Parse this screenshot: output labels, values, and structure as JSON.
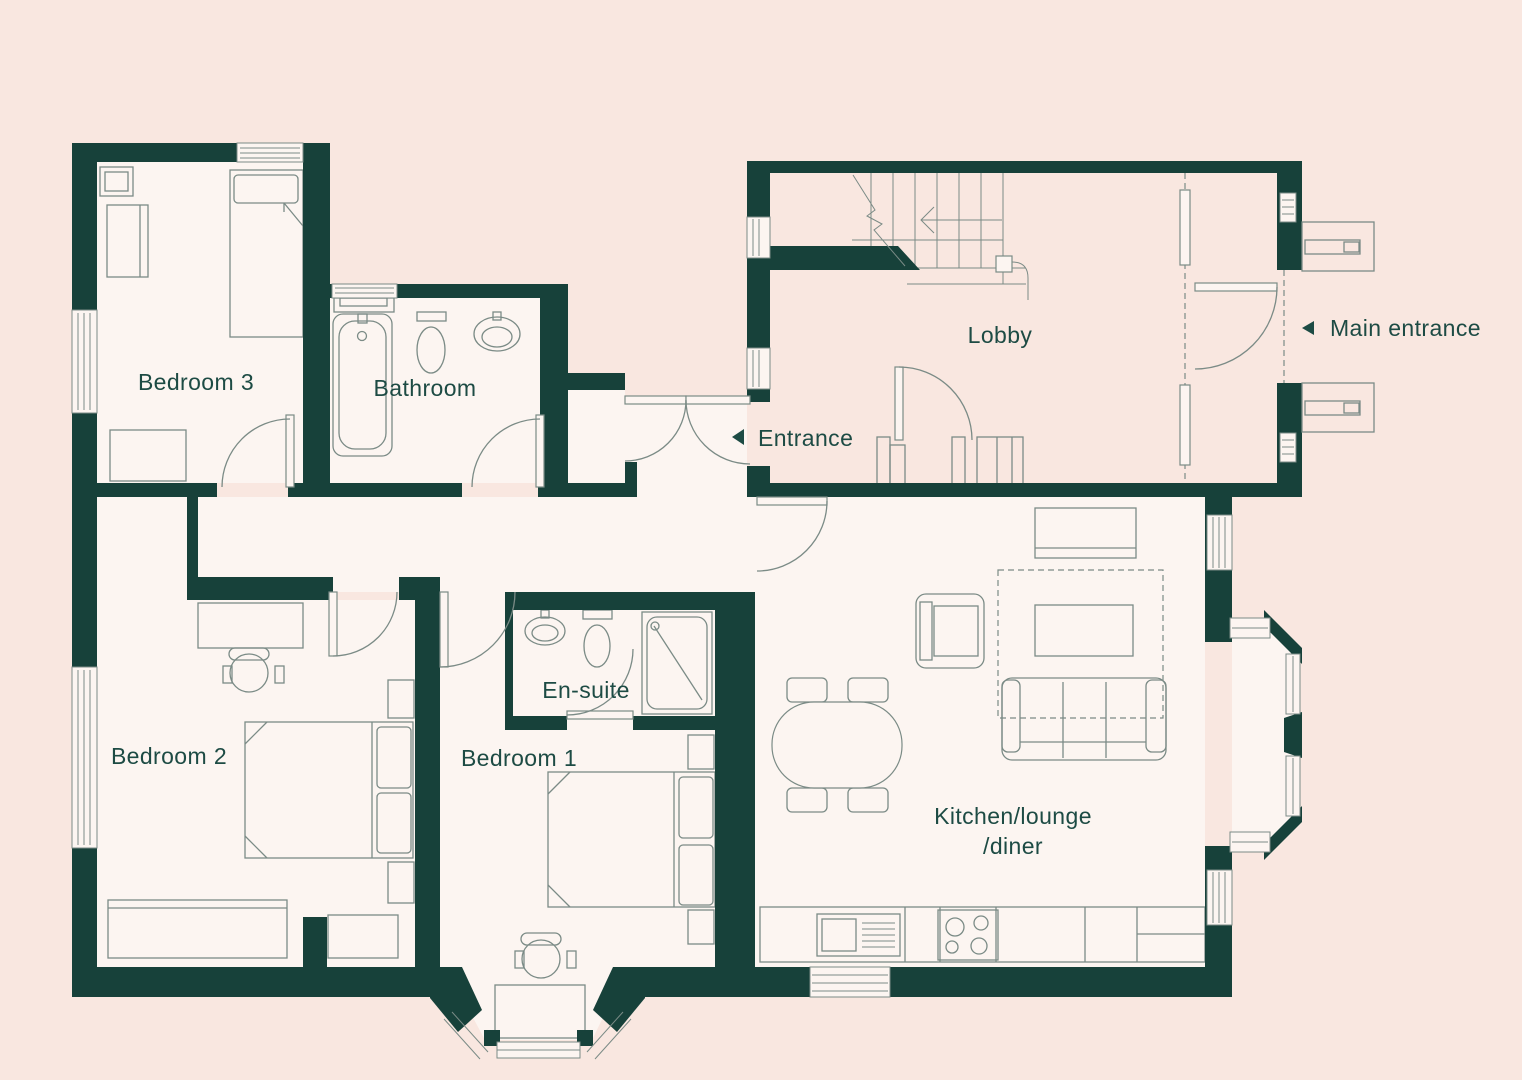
{
  "theme": {
    "background": "#f9e7e0",
    "floor": "#fcf5f1",
    "wall": "#17413a",
    "line": "#7b8b86",
    "ink": "#1d4b44"
  },
  "rooms": {
    "bedroom3": {
      "label": "Bedroom 3"
    },
    "bathroom": {
      "label": "Bathroom"
    },
    "lobby": {
      "label": "Lobby"
    },
    "ensuite": {
      "label": "En-suite"
    },
    "bedroom1": {
      "label": "Bedroom 1"
    },
    "bedroom2": {
      "label": "Bedroom 2"
    },
    "kitchen": {
      "label_line1": "Kitchen/lounge",
      "label_line2": "/diner"
    }
  },
  "annotations": {
    "entrance": {
      "label": "Entrance"
    },
    "main_entrance": {
      "label": "Main entrance"
    }
  }
}
